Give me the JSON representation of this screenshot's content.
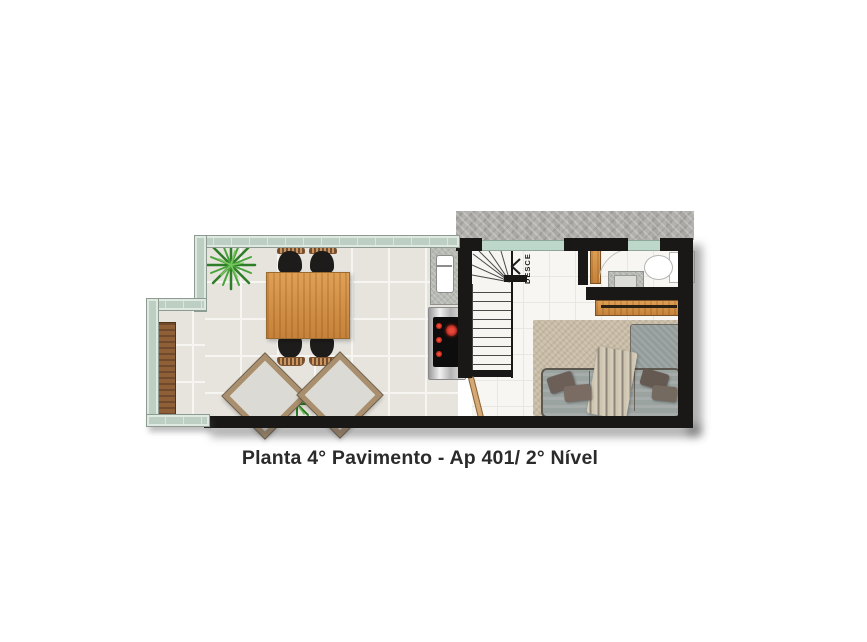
{
  "plan": {
    "title": "Planta 4° Pavimento - Ap 401/ 2° Nível",
    "stairs": {
      "label": "DESCE",
      "direction_icon": "chevron-left"
    },
    "rooms": [
      "terrace-gourmet",
      "kitchen-counter",
      "stair-hall",
      "bathroom",
      "living-bedroom"
    ],
    "furniture": {
      "terrace": [
        "wooden-bench",
        "dining-table",
        "dining-chairs-x4",
        "lounge-chairs-x2",
        "plants-x2"
      ],
      "kitchen": [
        "sink-counter",
        "cooktop"
      ],
      "bathroom": [
        "door",
        "vanity-sink",
        "toilet"
      ],
      "living": [
        "wood-shelf",
        "rug",
        "sofa-bed",
        "pillows-x4",
        "striped-throw"
      ]
    },
    "palette": {
      "wall": "#191816",
      "window_glass": "#bdd8cb",
      "railing_glass": "#bccfc2",
      "terrace_tile": "#e7e4de",
      "interior_floor": "#f7f6f3",
      "wood": "#c98f4e",
      "bench_wood": "#8f5f38",
      "rug": "#c8bca6",
      "sofa": "#9ba3a1",
      "pillow": "#6c5f58",
      "burner_red": "#c4281e",
      "concrete_band": "#b2b1ad",
      "plant_green": "#3c9234"
    }
  }
}
